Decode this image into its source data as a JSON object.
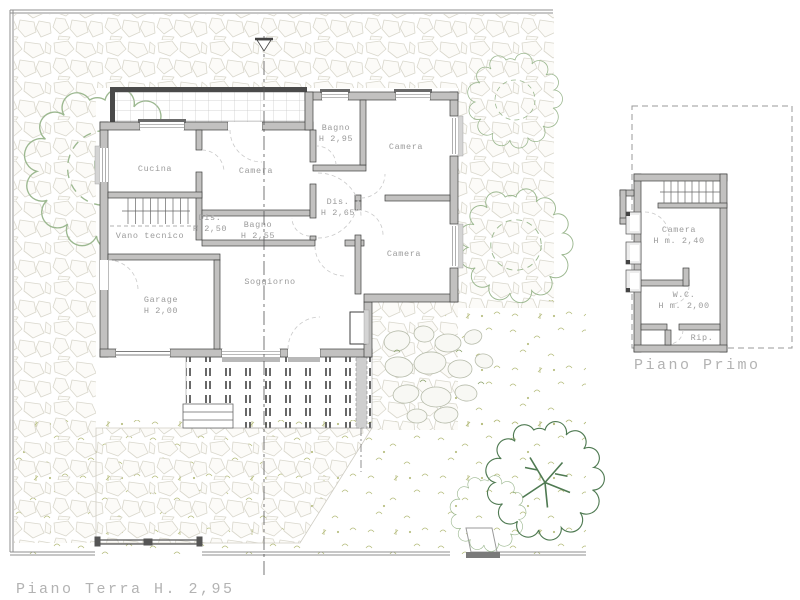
{
  "drawing": {
    "ground_floor": {
      "title": "Piano Terra  H. 2,95",
      "rooms": [
        {
          "name": "Cucina",
          "height": ""
        },
        {
          "name": "Camera",
          "height": ""
        },
        {
          "name": "Bagno",
          "height": "H 2,95"
        },
        {
          "name": "Camera",
          "height": ""
        },
        {
          "name": "Dis.",
          "height": "H 2,65"
        },
        {
          "name": "Bagno",
          "height": "H 2,55"
        },
        {
          "name": "Dis.",
          "height": "H 2,50"
        },
        {
          "name": "Vano tecnico",
          "height": ""
        },
        {
          "name": "Garage",
          "height": "H 2,00"
        },
        {
          "name": "Soggiorno",
          "height": ""
        },
        {
          "name": "Camera",
          "height": ""
        }
      ]
    },
    "first_floor": {
      "title": "Piano Primo",
      "rooms": [
        {
          "name": "Camera",
          "height": "H m. 2,40"
        },
        {
          "name": "W.C.",
          "height": "H m. 2,00"
        },
        {
          "name": "Rip.",
          "height": ""
        }
      ]
    },
    "colors": {
      "paper": "#ffffff",
      "wall_fill": "#c2c1c0",
      "wall_stroke": "#3f3f3f",
      "room_text": "#9b9b9b",
      "title_text": "#b3b3b3",
      "tree_green": "#9cb890",
      "dark_tree_green": "#4f7a52",
      "stone_outline": "#d9d7cc",
      "grass_green": "#b6bd7e",
      "deck_line": "#4d4d4d",
      "door_arc": "#c9c9c9"
    }
  }
}
